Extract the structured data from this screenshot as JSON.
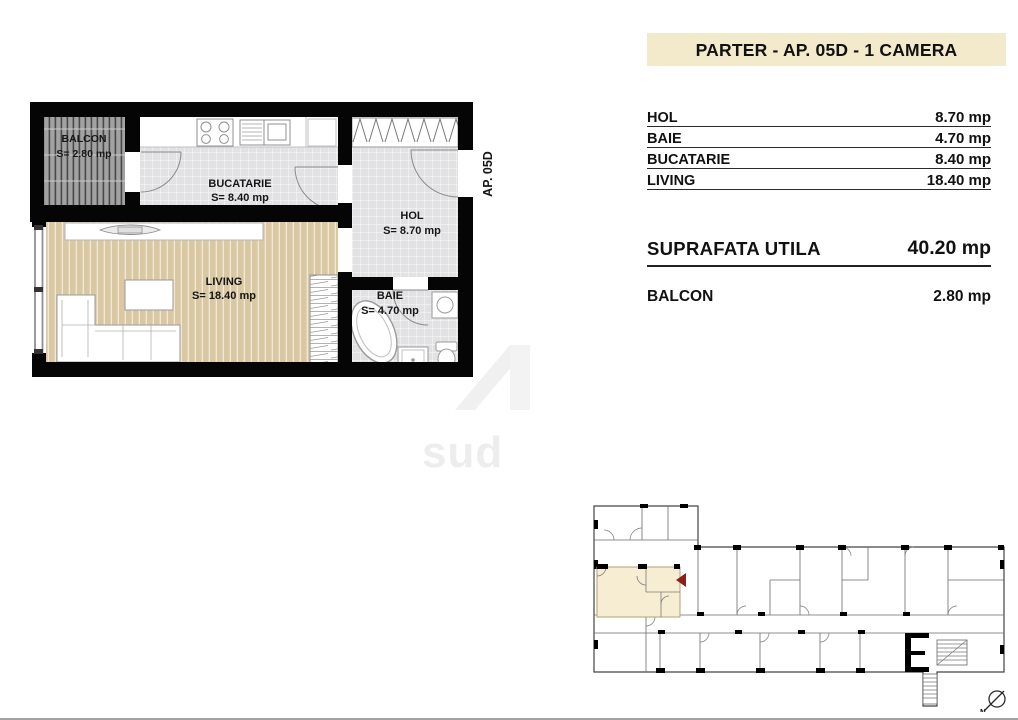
{
  "title": "PARTER - AP. 05D - 1 CAMERA",
  "floor_plan": {
    "unit_tag": "AP. 05D",
    "rooms": {
      "balcon": {
        "name": "BALCON",
        "area": "S= 2.80 mp"
      },
      "bucatarie": {
        "name": "BUCATARIE",
        "area": "S= 8.40 mp"
      },
      "hol": {
        "name": "HOL",
        "area": "S= 8.70 mp"
      },
      "living": {
        "name": "LIVING",
        "area": "S= 18.40 mp"
      },
      "baie": {
        "name": "BAIE",
        "area": "S= 4.70 mp"
      }
    }
  },
  "area_table": {
    "rows": [
      {
        "label": "HOL",
        "value": "8.70 mp"
      },
      {
        "label": "BAIE",
        "value": "4.70 mp"
      },
      {
        "label": "BUCATARIE",
        "value": "8.40 mp"
      },
      {
        "label": "LIVING",
        "value": "18.40 mp"
      }
    ],
    "total": {
      "label": "SUPRAFATA UTILA",
      "value": "40.20 mp"
    },
    "balcony": {
      "label": "BALCON",
      "value": "2.80 mp"
    }
  },
  "overview": {
    "north_label": "N"
  },
  "watermark": {
    "text": "sud"
  },
  "colors": {
    "accent_beige": "#f3e9cb",
    "highlight_unit": "#f6edd3",
    "arrow_red": "#8e1f1a",
    "wall_black": "#050505",
    "wood_floor": "#d9c8a2",
    "tile_floor": "#e2e2e4"
  }
}
